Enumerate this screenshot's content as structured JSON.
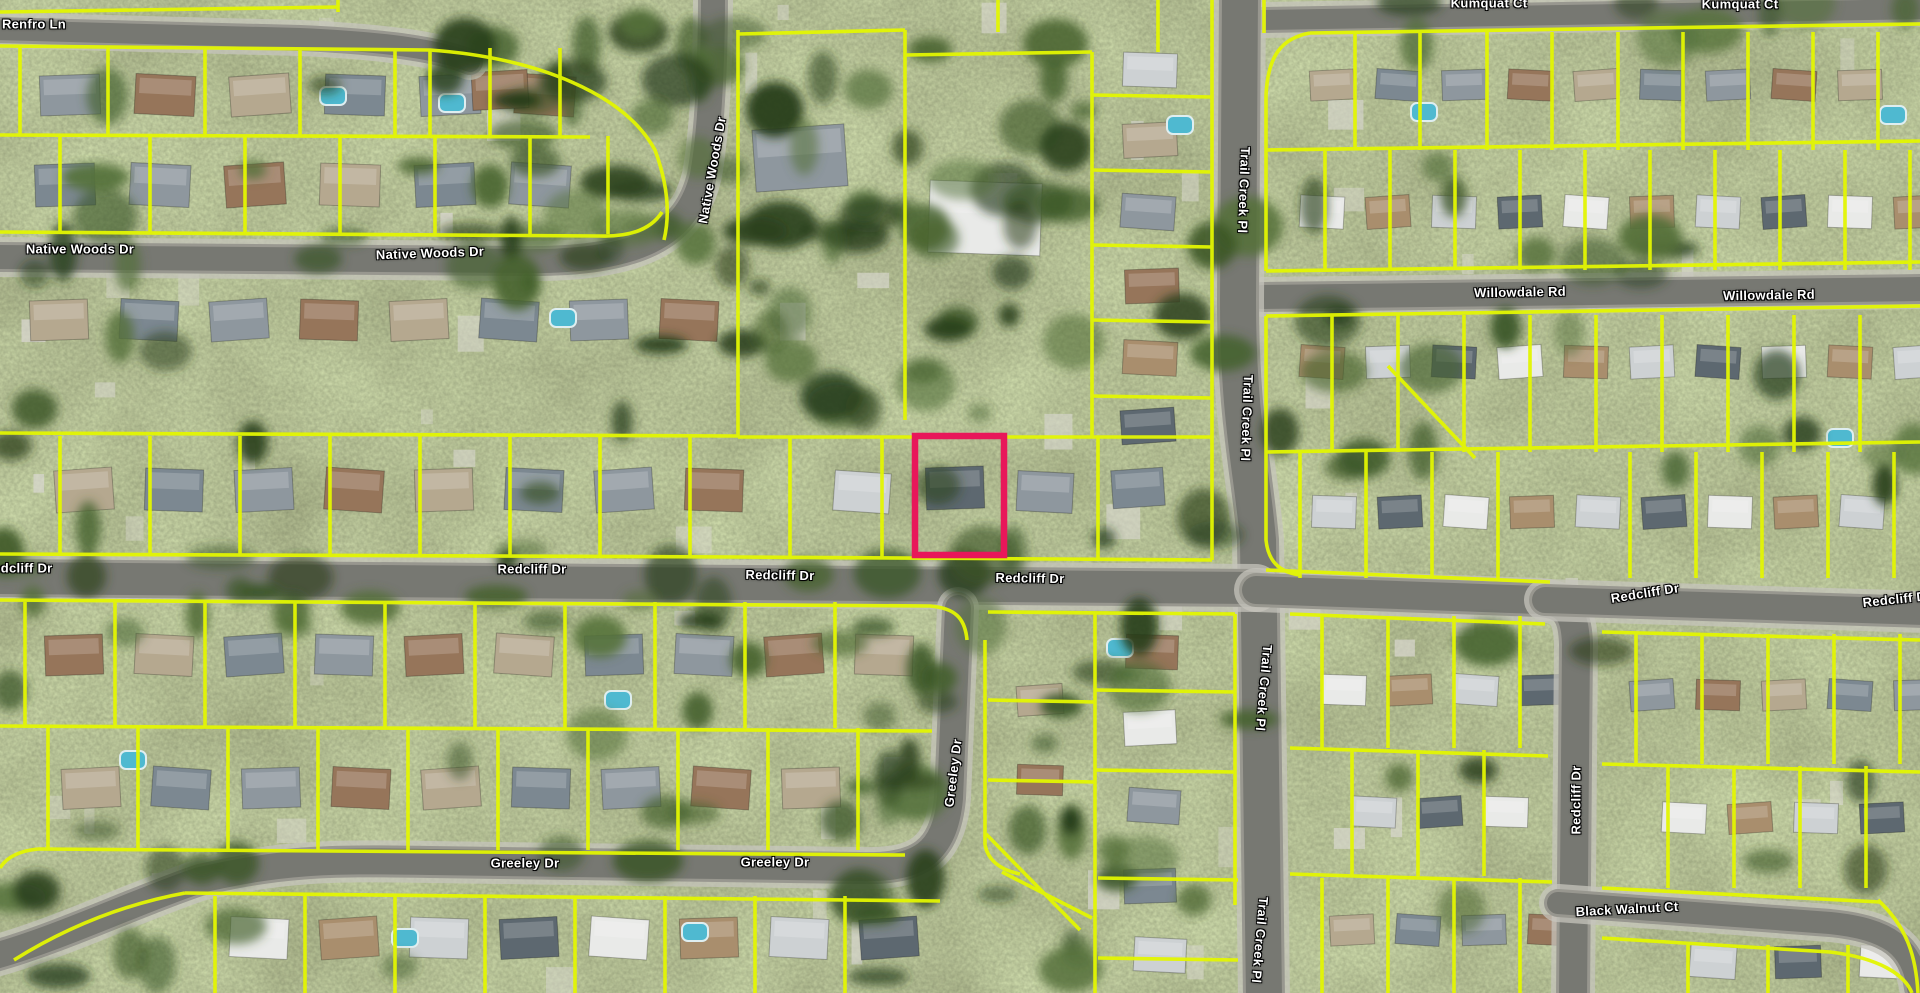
{
  "map": {
    "view_type_label": "aerial parcel map",
    "streets": {
      "renfro_ln": "Renfro Ln",
      "kumquat_ct": "Kumquat Ct",
      "native_woods_dr": "Native Woods Dr",
      "willowdale_rd": "Willowdale Rd",
      "trail_creek_pl": "Trail Creek Pl",
      "redcliff_dr": "Redcliff Dr",
      "greeley_dr": "Greeley Dr",
      "black_walnut_ct": "Black Walnut Ct"
    },
    "colors": {
      "parcel_line": "#e3f602",
      "selected_parcel": "#e8175a",
      "road": "#98978f",
      "label_text": "#ffffff"
    },
    "selected_parcel": {
      "status": "highlighted"
    }
  }
}
